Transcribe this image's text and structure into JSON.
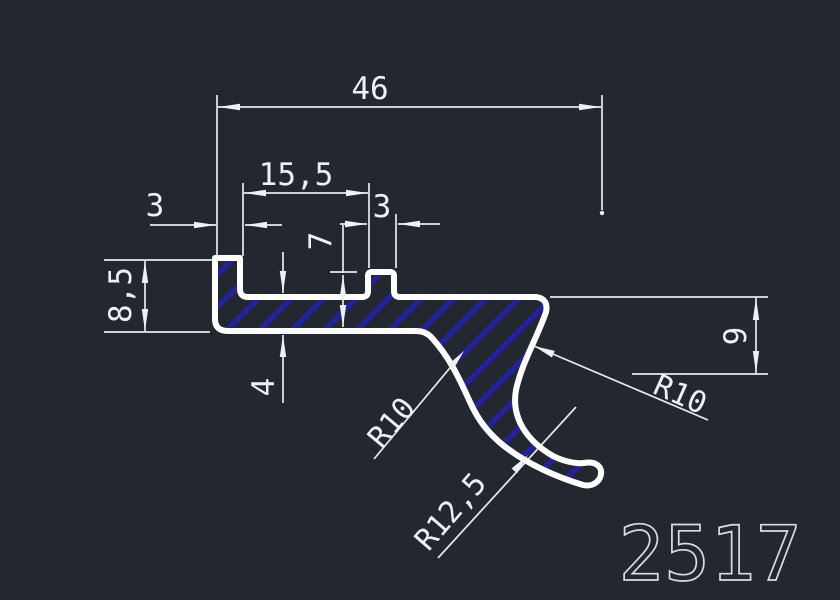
{
  "title": "Extrusion profile cross-section drawing",
  "part_number": "2517",
  "dimensions": {
    "overall_width": "46",
    "slot_width": "15,5",
    "left_lip_width": "3",
    "right_lip_width": "3",
    "left_height": "8,5",
    "right_lip_depth": "7",
    "wall_thickness": "4",
    "hook_drop": "9"
  },
  "radii": {
    "bottom_fillet": "R10",
    "hook_inner": "R10",
    "hook_outer": "R12,5"
  },
  "colors": {
    "background": "#23272f",
    "outline": "#ffffff",
    "hatch": "#22229c",
    "dimension_lines": "#e9eaec",
    "part_number": "#d9dde1"
  }
}
